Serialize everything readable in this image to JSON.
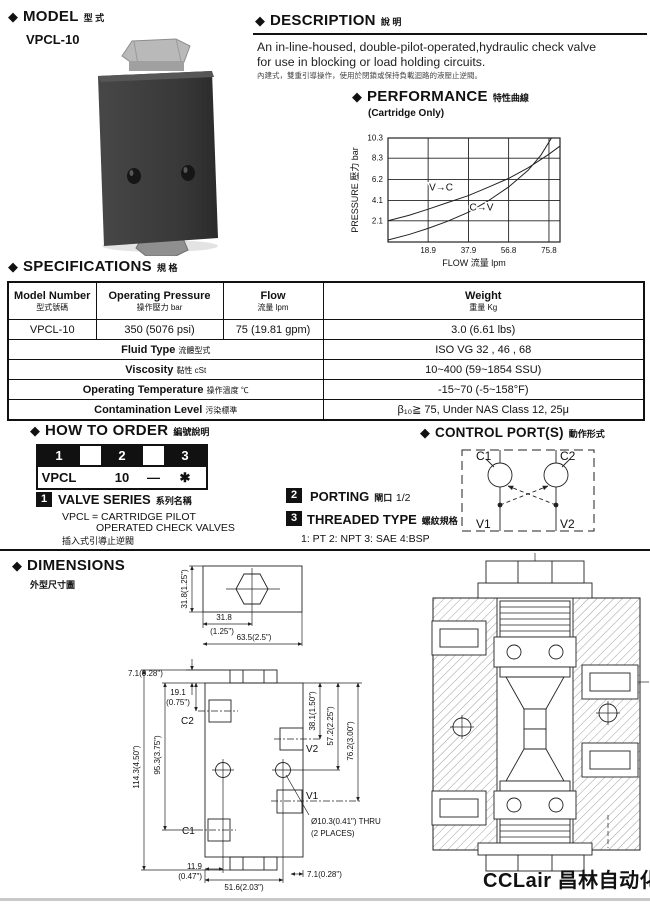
{
  "icons": {
    "diamond": "◆"
  },
  "model": {
    "header": "MODEL",
    "header_cn": "型  式",
    "name": "VPCL-10"
  },
  "description": {
    "header": "DESCRIPTION",
    "header_cn": "說  明",
    "line1": "An in-line-housed, double-pilot-operated,hydraulic check valve",
    "line2": "for use in blocking or load holding circuits.",
    "line3_cn": "內建式，雙重引導操作，使用於閉鎖或保持負載迴路的液壓止逆閥。"
  },
  "performance": {
    "header": "PERFORMANCE",
    "header_cn": "特性曲線",
    "subtitle": "(Cartridge Only)"
  },
  "chart_data": {
    "type": "line",
    "title": "PERFORMANCE (Cartridge Only)",
    "xlabel": "FLOW 流量  lpm",
    "ylabel": "PRESSURE 壓力  bar",
    "xlim": [
      0,
      81
    ],
    "ylim": [
      0,
      10.3
    ],
    "x_ticks": [
      18.9,
      37.9,
      56.8,
      75.8
    ],
    "y_ticks": [
      2.1,
      4.1,
      6.2,
      8.3,
      10.3
    ],
    "grid": true,
    "legend_position": "on-line-labels",
    "series": [
      {
        "name": "V→C",
        "label_at": [
          25,
          5.1
        ],
        "points": [
          [
            0,
            2.1
          ],
          [
            10,
            2.65
          ],
          [
            18.9,
            3.25
          ],
          [
            28,
            3.9
          ],
          [
            37.9,
            4.6
          ],
          [
            47,
            5.4
          ],
          [
            56.8,
            6.3
          ],
          [
            66,
            7.35
          ],
          [
            75.8,
            8.7
          ],
          [
            81,
            9.5
          ]
        ]
      },
      {
        "name": "C→V",
        "label_at": [
          44,
          3.1
        ],
        "points": [
          [
            0,
            0.2
          ],
          [
            10,
            0.75
          ],
          [
            18.9,
            1.35
          ],
          [
            28,
            2.05
          ],
          [
            37.9,
            2.95
          ],
          [
            47,
            4.05
          ],
          [
            56.8,
            5.45
          ],
          [
            66,
            7.1
          ],
          [
            72,
            8.6
          ],
          [
            77,
            10.3
          ]
        ]
      }
    ]
  },
  "specifications": {
    "header": "SPECIFICATIONS",
    "header_cn": "規  格",
    "columns": [
      {
        "en": "Model Number",
        "cn": "型式號碼"
      },
      {
        "en": "Operating Pressure",
        "cn": "操作壓力  bar"
      },
      {
        "en": "Flow",
        "cn": "流量  lpm"
      },
      {
        "en": "Weight",
        "cn": "重量 Kg"
      }
    ],
    "row": [
      "VPCL-10",
      "350 (5076 psi)",
      "75 (19.81 gpm)",
      "3.0 (6.61 lbs)"
    ],
    "extra_rows": [
      {
        "label_en": "Fluid Type",
        "label_cn": "流體型式",
        "value": "ISO VG 32 , 46 , 68"
      },
      {
        "label_en": "Viscosity",
        "label_cn": "黏性  cSt",
        "value": "10~400 (59~1854 SSU)"
      },
      {
        "label_en": "Operating Temperature",
        "label_cn": "操作溫度 ℃",
        "value": "-15~70 (-5~158°F)"
      },
      {
        "label_en": "Contamination Level",
        "label_cn": "污染標準",
        "value": "β₁₀≧ 75, Under NAS Class 12, 25μ"
      }
    ]
  },
  "how_to_order": {
    "header": "HOW TO  ORDER",
    "header_cn": "編號說明",
    "boxes": [
      "1",
      "2",
      "3"
    ],
    "code_parts": [
      "VPCL",
      "10",
      "—",
      "✱"
    ],
    "item1": {
      "num": "1",
      "title": "VALVE SERIES",
      "title_cn": "系列名稱",
      "line1": "VPCL = CARTRIDGE PILOT",
      "line2": "OPERATED CHECK VALVES",
      "line3_cn": "插入式引導止逆閥"
    },
    "item2": {
      "num": "2",
      "title": "PORTING",
      "title_cn": "閘口",
      "suffix": "1/2"
    },
    "item3": {
      "num": "3",
      "title": "THREADED TYPE",
      "title_cn": "螺紋規格",
      "sub": "1: PT   2: NPT   3: SAE   4:BSP"
    }
  },
  "control_ports": {
    "header": "CONTROL PORT(S)",
    "header_cn": "動作形式",
    "c1": "C1",
    "c2": "C2",
    "v1": "V1",
    "v2": "V2"
  },
  "dimensions": {
    "header": "DIMENSIONS",
    "header_cn": "外型尺寸圖",
    "top_view": {
      "side": "31.8(1.25\")",
      "center1": "31.8",
      "center2": "(1.25\")",
      "width": "63.5(2.5\")"
    },
    "front_view": {
      "top_offset": "7.1(0.28\")",
      "c2_off1": "19.1",
      "c2_off2": "(0.75\")",
      "left_inner": "95.3(3.75\")",
      "left_outer": "114.3(4.50\")",
      "right_1": "38.1(1.50\")",
      "right_2": "57.2(2.25\")",
      "right_3": "76.2(3.00\")",
      "c1": "C1",
      "c2": "C2",
      "v1": "V1",
      "v2": "V2",
      "thru1": "Ø10.3(0.41\") THRU",
      "thru2": "(2 PLACES)",
      "bl1": "11.9",
      "bl2": "(0.47\")",
      "bottom_w": "51.6(2.03\")",
      "bottom_r": "7.1(0.28\")"
    }
  },
  "footer": {
    "logo": "CCLair 昌林自动化"
  }
}
